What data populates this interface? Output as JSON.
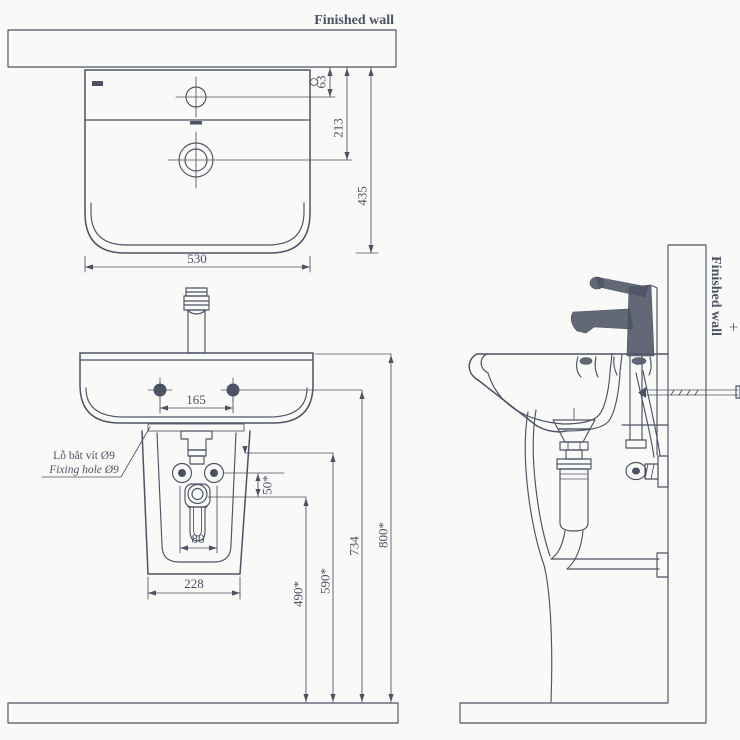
{
  "labels": {
    "finished_wall": "Finished wall",
    "fixing_hole_line1": "Lỗ bắt vít Ø9",
    "fixing_hole_line2": "Fixing hole Ø9"
  },
  "dims": {
    "top_faucet_to_wall": "63",
    "top_drain_to_wall": "213",
    "top_depth": "435",
    "top_width": "530",
    "front_hole_spacing": "165",
    "front_trap_width": "80",
    "front_pedestal_width": "228",
    "front_supply_drop": "50*",
    "front_drain_height": "490*",
    "front_supply_height": "590*",
    "front_fixing_height": "734",
    "front_rim_height": "800*"
  },
  "colors": {
    "ink": "#4d5365",
    "paper": "#f9f9f7",
    "band": "#f1f1ee"
  }
}
